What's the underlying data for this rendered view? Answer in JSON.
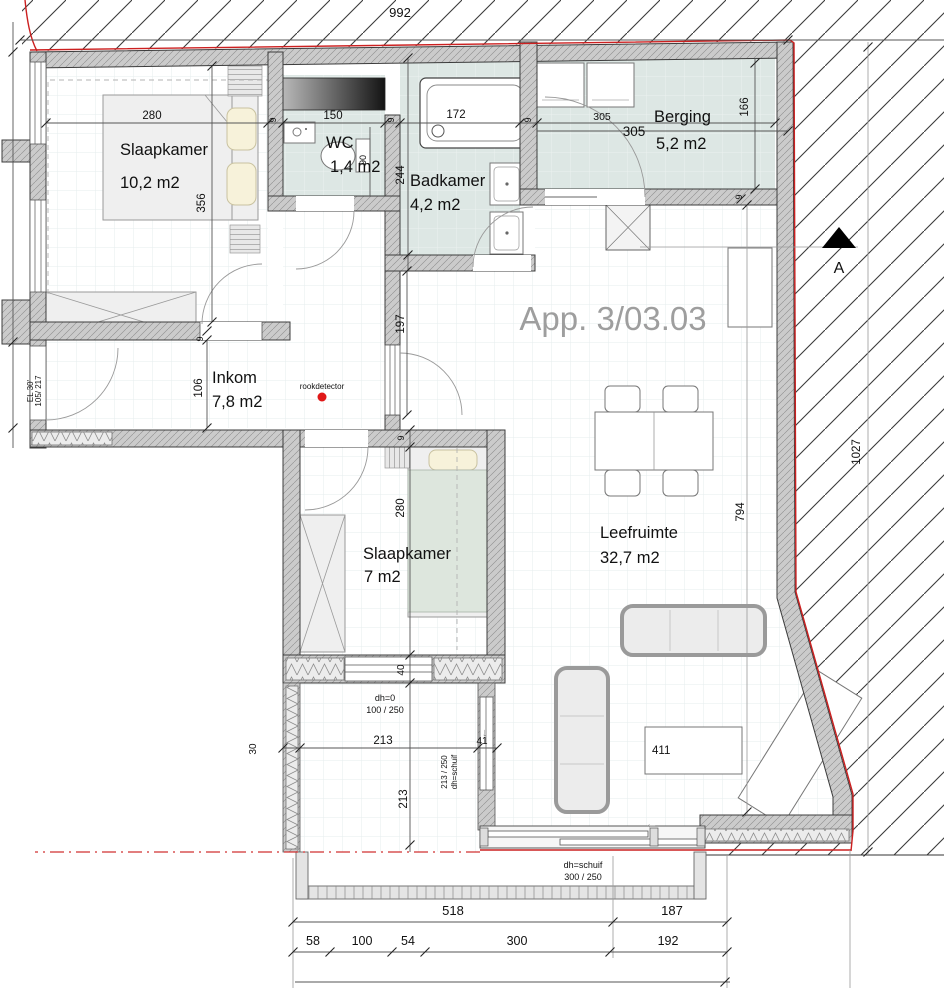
{
  "title": "App. 3/03.03",
  "rooms": [
    {
      "name": "Slaapkamer",
      "area": "10,2 m2"
    },
    {
      "name": "WC",
      "area": "1,4 m2"
    },
    {
      "name": "Badkamer",
      "area": "4,2 m2"
    },
    {
      "name": "Berging",
      "area": "5,2 m2"
    },
    {
      "name": "Inkom",
      "area": "7,8 m2"
    },
    {
      "name": "Slaapkamer",
      "area": "7 m2"
    },
    {
      "name": "Leefruimte",
      "area": "32,7 m2"
    }
  ],
  "dims": {
    "site_width": "992",
    "site_height": "1027",
    "sk1_width": "280",
    "sk1_depth": "356",
    "wall": "9",
    "wc_width": "150",
    "wc_depth": "90",
    "tub_length": "172",
    "bad_depth": "244",
    "berg_width_a": "305",
    "berg_width_b": "305",
    "berg_depth": "166",
    "inkom_depth": "106",
    "hall_depth": "197",
    "sk2_depth": "280",
    "sk2_wall": "40",
    "leef_depth": "794",
    "cabinet": "411",
    "balc_width": "213",
    "balc_depth": "213",
    "balc_door": "41",
    "balc_wall": "30",
    "b518": "518",
    "b187": "187",
    "b58": "58",
    "b100": "100",
    "b54": "54",
    "b300": "300",
    "b192": "192"
  },
  "annotations": {
    "rookdetector": "rookdetector",
    "section": "A",
    "door_fire_rating": "EL 30'",
    "door_size": "105/ 217",
    "balcony_door_height": "dh=0",
    "balcony_door_size": "100 / 250",
    "slide_side_size": "213 / 250",
    "slide_side_type": "dh=schuif",
    "slide_bottom_type": "dh=schuif",
    "slide_bottom_size": "300 / 250",
    "arrow_left": "←",
    "arrow_down": "↓"
  },
  "colors": {
    "wet_floor": "#dde7e4",
    "wall_gray": "#c9c9c9",
    "accent_red": "#cc2020",
    "title_gray": "#9e9e9e"
  }
}
